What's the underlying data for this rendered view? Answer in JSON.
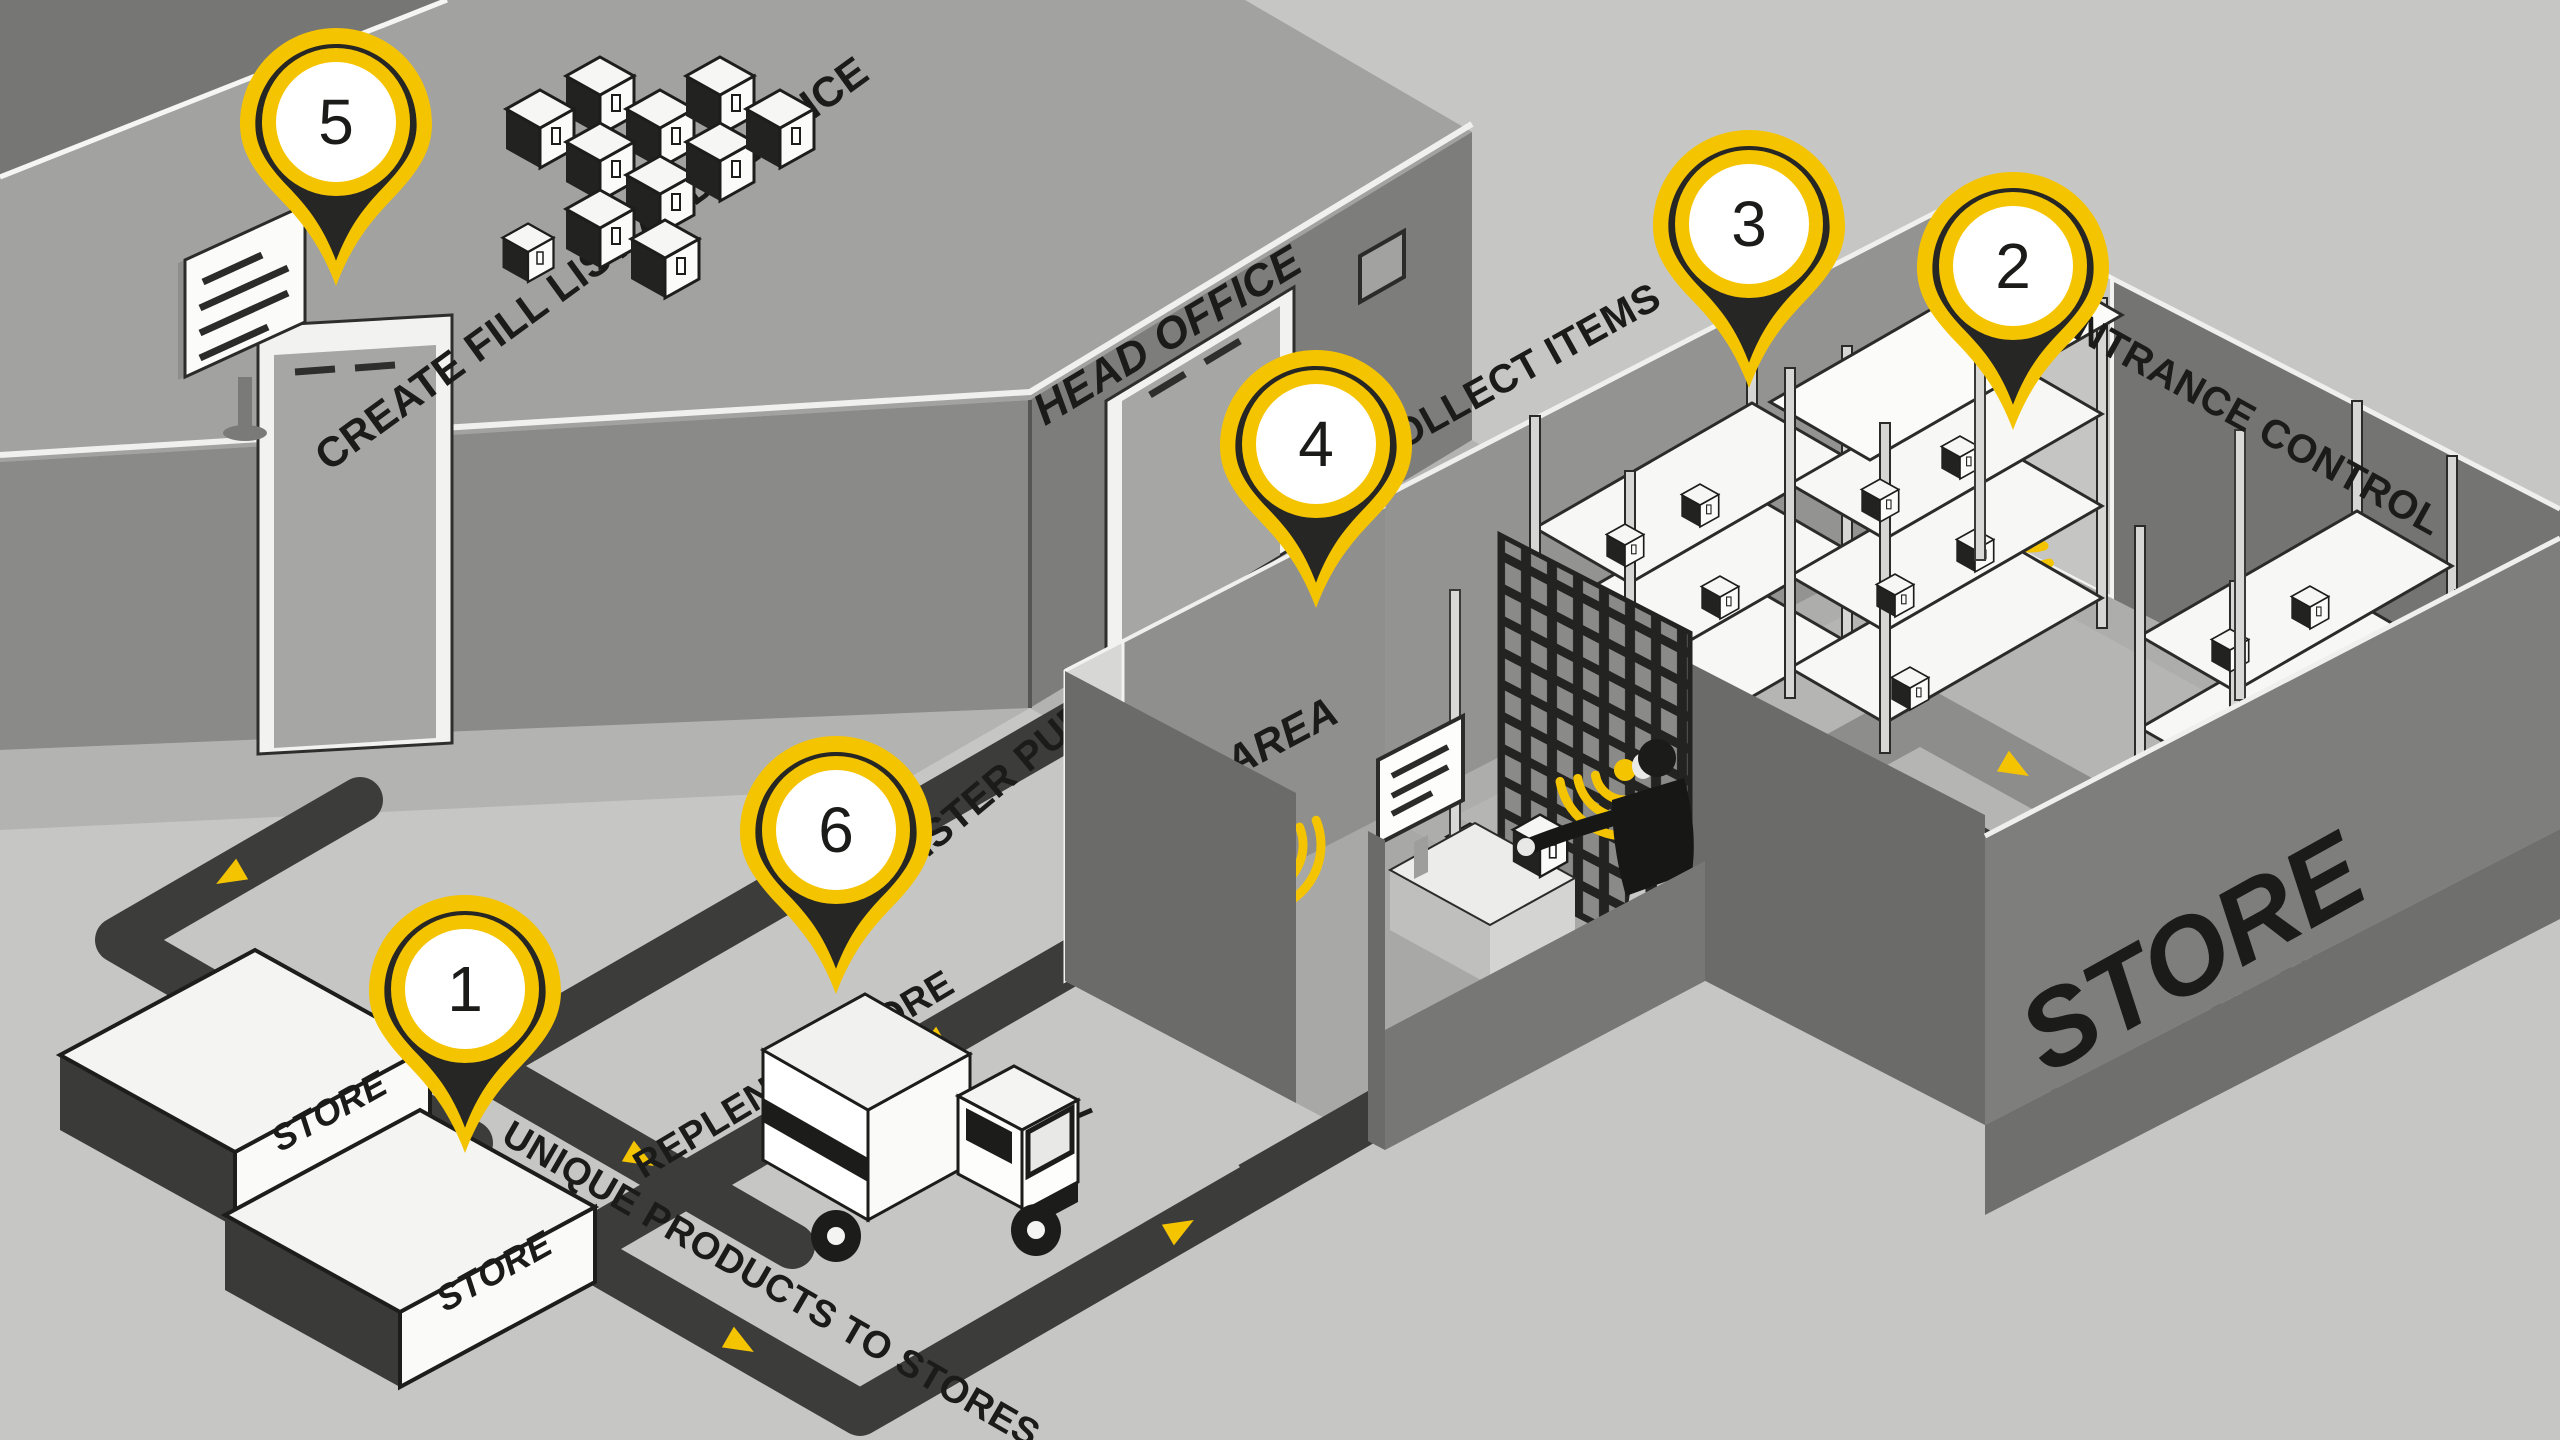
{
  "pins": [
    {
      "number": "1"
    },
    {
      "number": "2"
    },
    {
      "number": "3"
    },
    {
      "number": "4"
    },
    {
      "number": "5"
    },
    {
      "number": "6"
    }
  ],
  "labels": {
    "head_office": "HEAD OFFICE",
    "create_fill_list": "CREATE FILL LIST AND INVOICE",
    "collect_items": "COLLECT ITEMS",
    "entrance_control": "ENTRANCE CONTROL",
    "register_purchases": "REGISTER PURCHASES",
    "read_area": "READ AREA",
    "replenish_store": "REPLENISH STORE",
    "unique_products": "UNIQUE PRODUCTS TO STORES",
    "store_wall": "STORE",
    "store_box_a": "STORE",
    "store_box_b": "STORE"
  },
  "colors": {
    "background": "#c6c6c5",
    "accent_yellow": "#f5c400",
    "pin_dark": "#262624",
    "path_dark": "#3c3c3b",
    "text_black": "#1b1b19",
    "wall_light": "#8a8a89",
    "wall_dark": "#6b6b6a",
    "roof_gray": "#a2a2a1"
  },
  "icons": {
    "location_pin": "map-pin-marker",
    "rfid_wave": "wireless-signal-arcs",
    "route_arrow": "direction-triangle"
  }
}
